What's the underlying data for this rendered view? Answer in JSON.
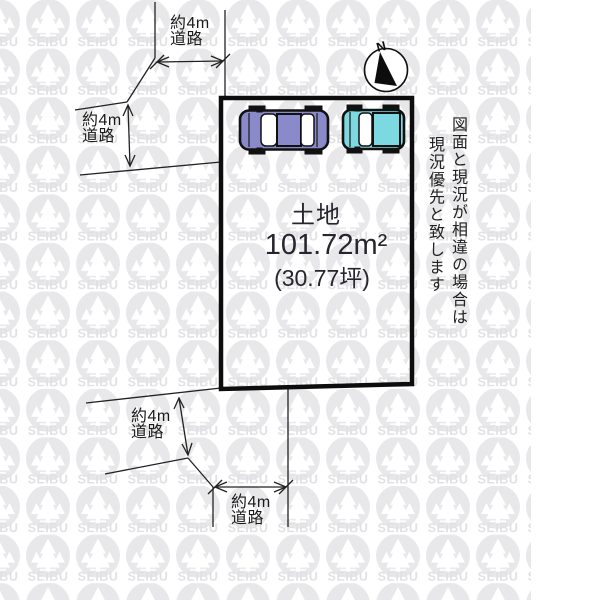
{
  "diagram": {
    "plot": {
      "label": "土地",
      "area": "101.72m²",
      "area_tsubo": "(30.77坪)"
    },
    "roads": [
      {
        "position": "top",
        "line1": "約4m",
        "line2": "道路"
      },
      {
        "position": "left",
        "line1": "約4m",
        "line2": "道路"
      },
      {
        "position": "bottom-left",
        "line1": "約4m",
        "line2": "道路"
      },
      {
        "position": "bottom",
        "line1": "約4m",
        "line2": "道路"
      }
    ],
    "compass": {
      "north_label": "N"
    },
    "disclaimer": {
      "column1": "図面と現況が相違の場合は",
      "column2": "現況優先と致します"
    },
    "watermark": {
      "brand": "SEIBU",
      "circle_color": "#e8e8ea",
      "text_color": "#e1e1e4"
    },
    "colors": {
      "line": "#222222",
      "plot_border": "#0d0d0d",
      "car_sedan": "#8a8acb",
      "car_van": "#7cd8e1",
      "car_window": "#ffffff"
    }
  }
}
